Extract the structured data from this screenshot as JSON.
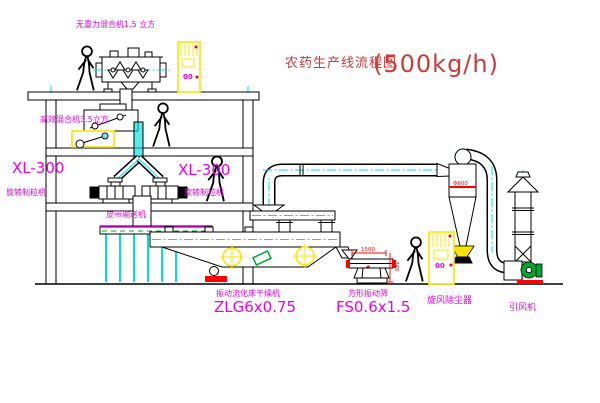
{
  "title": {
    "text": "农药生产线流程图",
    "capacity": "(500kg/h)"
  },
  "equipment": {
    "zero_gravity_mixer": {
      "label": "无重力混合机1.5 立方"
    },
    "high_efficiency_mixer": {
      "label": "高效混合机3.5立方"
    },
    "granulator_left": {
      "model": "XL-300",
      "name": "旋转制粒机"
    },
    "granulator_right": {
      "model": "XL-300",
      "name": "旋转制粒机"
    },
    "belt_conveyor": {
      "name": "皮带输送机"
    },
    "fluid_bed_dryer": {
      "name": "振动流化床干燥机",
      "model": "ZLG6x0.75"
    },
    "square_sieve": {
      "name": "方形振动筛",
      "model": "FS0.6x1.5",
      "dim_width": "1500",
      "dim_height": "745"
    },
    "cyclone": {
      "name": "旋风除尘器",
      "dim": "Φ600"
    },
    "induced_draft_fan": {
      "name": "引风机"
    },
    "control_cabinet_top": {
      "display": "00"
    },
    "control_cabinet_right": {
      "display": "00"
    }
  },
  "colors": {
    "magenta": "#E800E8",
    "title-red": "#CC3A3A",
    "cyan": "#00DEDE",
    "yellow": "#FFE400",
    "red": "#FF0000",
    "green": "#00A830",
    "bg": "#FFFFFF"
  }
}
